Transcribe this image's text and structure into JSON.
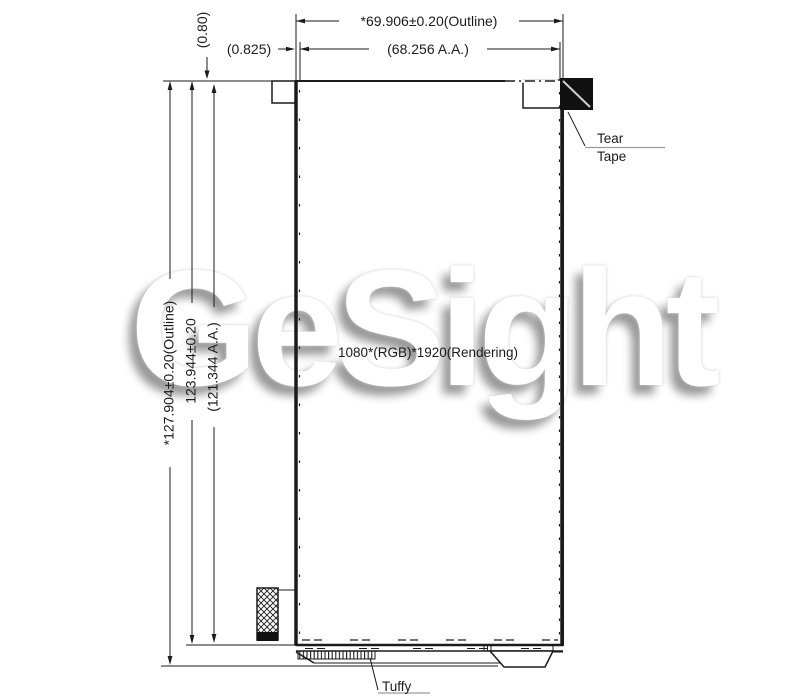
{
  "labels": {
    "outline_width": "*69.906±0.20(Outline)",
    "aa_width": "(68.256 A.A.)",
    "gap_left": "(0.825)",
    "gap_top": "(0.80)",
    "outline_height": "*127.904±0.20(Outline)",
    "panel_height": "123.944±0.20",
    "aa_height": "(121.344 A.A.)",
    "resolution": "1080*(RGB)*1920(Rendering)",
    "tear_line1": "Tear",
    "tear_line2": "Tape",
    "tuffy": "Tuffy"
  },
  "watermark": "GeSight",
  "colors": {
    "line": "#1b1b1b",
    "tape_fill": "#111111",
    "tape_diagonal": "#cfcfcf"
  }
}
